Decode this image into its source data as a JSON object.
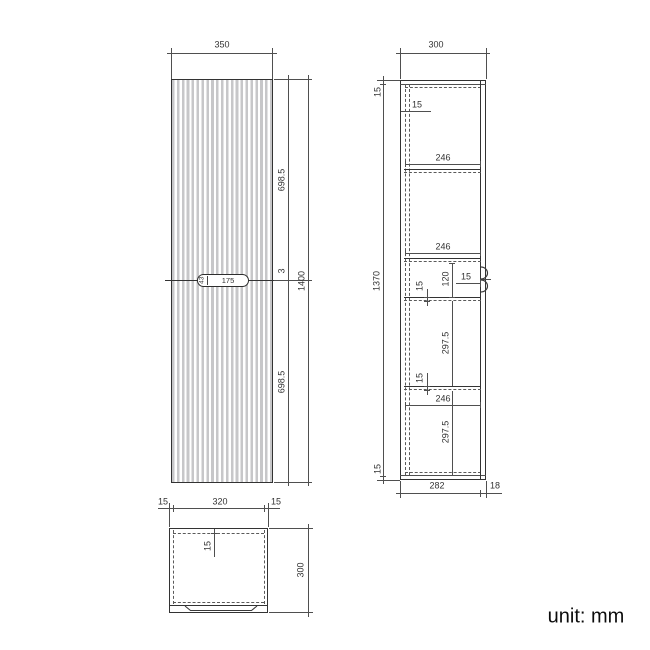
{
  "unit_label": "unit: mm",
  "front_view": {
    "width": "350",
    "height": "1400",
    "door_top_height": "698.5",
    "door_gap": "3",
    "door_bottom_height": "698.5",
    "handle_height": "43",
    "handle_width": "175"
  },
  "side_view": {
    "depth": "300",
    "top_panel": "15",
    "body_height": "1370",
    "bottom_panel": "15",
    "back_panel": "15",
    "shelf_depth_1": "246",
    "shelf_depth_2": "246",
    "shelf_depth_3": "246",
    "niche_height": "120",
    "shelf_thickness_1": "15",
    "shelf_thickness_2": "15",
    "door_thickness": "15",
    "compartment_height_1": "297.5",
    "compartment_height_2": "297.5",
    "body_depth": "282",
    "door_depth": "18"
  },
  "top_view": {
    "side_panel_left": "15",
    "interior_width": "320",
    "side_panel_right": "15",
    "depth": "300",
    "back_panel": "15"
  }
}
